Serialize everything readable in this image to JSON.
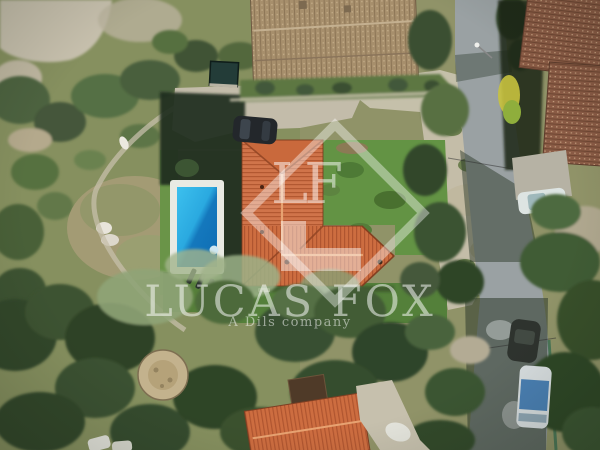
{
  "image": {
    "kind": "aerial drone photograph",
    "alt": "Overhead view of a villa with an L-shaped terracotta tile roof, rectangular swimming pool, lawn and wooded Mediterranean plot beside a curving road with neighbouring tiled roofs and parked vehicles"
  },
  "watermark": {
    "monogram": "LF",
    "brand_name": "LUCAS FOX",
    "tagline": "A Dils company",
    "color": "#ffffff"
  },
  "scene": {
    "objects": [
      "villa-terracotta-roof",
      "swimming-pool",
      "pool-deck",
      "sun-loungers",
      "lawn",
      "gravel-driveway",
      "black-car",
      "garden-shed",
      "neighbor-roof-north",
      "neighbor-roofs-east",
      "white-car",
      "road",
      "white-van",
      "dark-car",
      "round-stone-patio",
      "scrub-trees",
      "dry-ground",
      "bottom-house-roof"
    ],
    "colors": {
      "roof_terracotta": "#cf6f42",
      "roof_weathered_tan": "#a78f6c",
      "roof_weathered_red": "#8a5b45",
      "pool_water_light": "#3cc0ee",
      "pool_water_dark": "#0f6cb2",
      "pool_deck": "#e9eae3",
      "lawn_green": "#5f8f3f",
      "scrub_green_dark": "#32462b",
      "olive_green": "#8fa477",
      "dry_ground": "#c5beaa",
      "road_asphalt": "#9aa1a3",
      "shadow_dark": "#1f2a1e",
      "watermark_white": "#ffffff"
    }
  }
}
